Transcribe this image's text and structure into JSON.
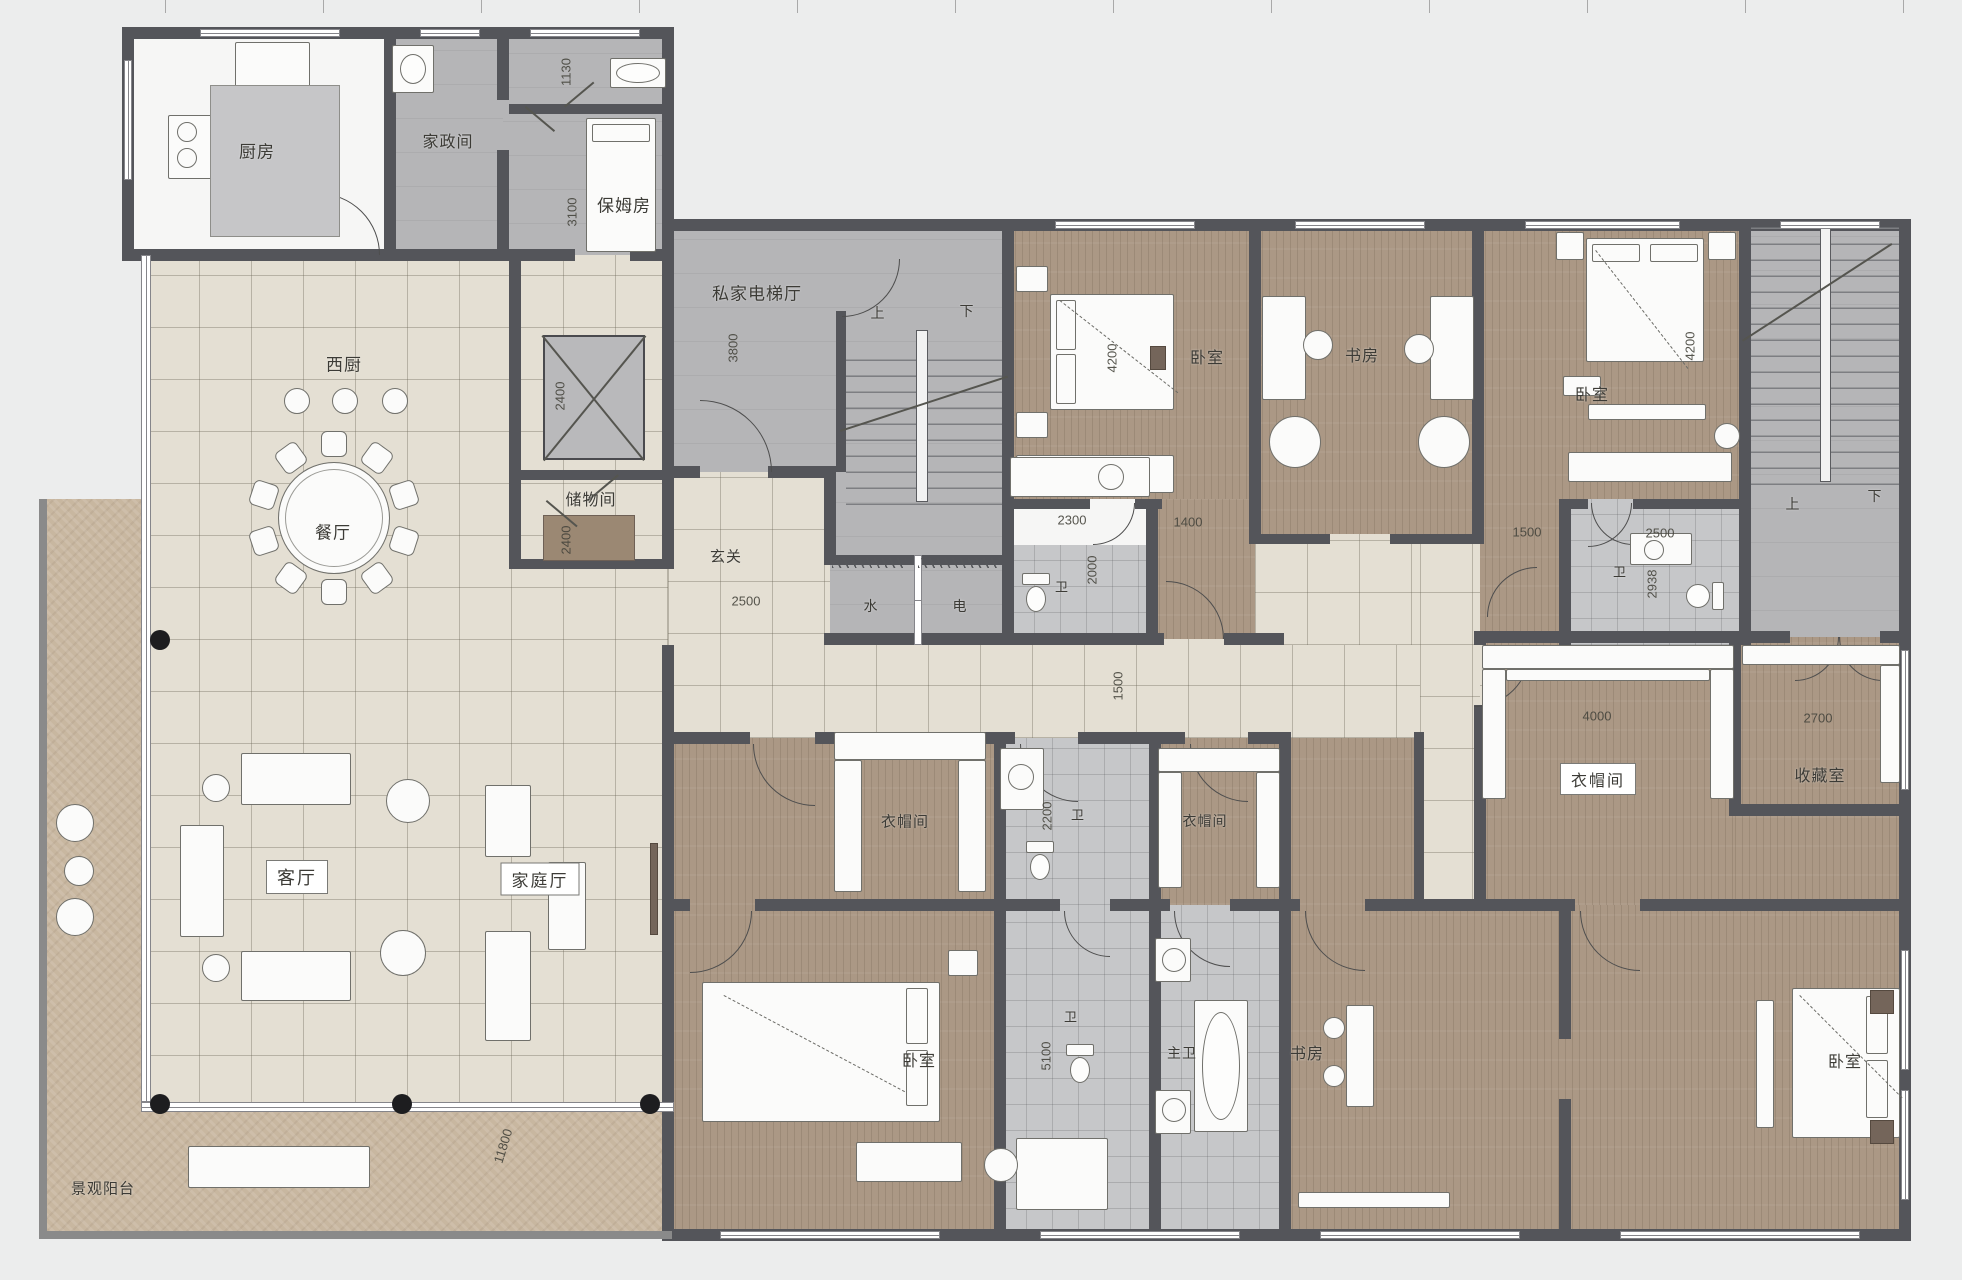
{
  "plan": {
    "title": "residential floor plan",
    "width": 1962,
    "height": 1280,
    "colors": {
      "wall": "#54555a",
      "tile_floor": "#e4dfd3",
      "wood_floor": "#ab9885",
      "gray_floor": "#b5b5b7",
      "bath_floor": "#c6c7c9",
      "balcony_floor": "#c8b7a0",
      "background": "#eceded",
      "label_text": "#3c3b36",
      "column": "#1d1d1f"
    }
  },
  "rooms": [
    {
      "name": "kitchen",
      "label": "厨房",
      "x": 257,
      "y": 150,
      "fs": 17,
      "boxed": false
    },
    {
      "name": "housekeeping-room",
      "label": "家政间",
      "x": 448,
      "y": 140,
      "fs": 16,
      "boxed": false
    },
    {
      "name": "nanny-room",
      "label": "保姆房",
      "x": 624,
      "y": 204,
      "fs": 17,
      "boxed": false
    },
    {
      "name": "private-elevator-hall",
      "label": "私家电梯厅",
      "x": 757,
      "y": 292,
      "fs": 17,
      "boxed": false
    },
    {
      "name": "west-kitchen",
      "label": "西厨",
      "x": 344,
      "y": 363,
      "fs": 17,
      "boxed": false
    },
    {
      "name": "dining-room",
      "label": "餐厅",
      "x": 333,
      "y": 531,
      "fs": 17,
      "boxed": false
    },
    {
      "name": "storage-room",
      "label": "储物间",
      "x": 591,
      "y": 498,
      "fs": 16,
      "boxed": false
    },
    {
      "name": "foyer",
      "label": "玄关",
      "x": 726,
      "y": 556,
      "fs": 15,
      "boxed": false
    },
    {
      "name": "water-meter",
      "label": "水",
      "x": 871,
      "y": 606,
      "fs": 14,
      "boxed": false
    },
    {
      "name": "electric-meter",
      "label": "电",
      "x": 960,
      "y": 606,
      "fs": 14,
      "boxed": false
    },
    {
      "name": "bedroom-1",
      "label": "卧室",
      "x": 1207,
      "y": 356,
      "fs": 16,
      "boxed": false
    },
    {
      "name": "study-1",
      "label": "书房",
      "x": 1362,
      "y": 354,
      "fs": 16,
      "boxed": false
    },
    {
      "name": "bedroom-2",
      "label": "卧室",
      "x": 1592,
      "y": 393,
      "fs": 16,
      "boxed": false
    },
    {
      "name": "bath-1",
      "label": "卫",
      "x": 1062,
      "y": 586,
      "fs": 13,
      "boxed": false
    },
    {
      "name": "bath-2",
      "label": "卫",
      "x": 1620,
      "y": 571,
      "fs": 13,
      "boxed": false
    },
    {
      "name": "stair1-up",
      "label": "上",
      "x": 878,
      "y": 313,
      "fs": 14,
      "boxed": false
    },
    {
      "name": "stair1-down",
      "label": "下",
      "x": 967,
      "y": 311,
      "fs": 14,
      "boxed": false
    },
    {
      "name": "stair2-up",
      "label": "上",
      "x": 1793,
      "y": 504,
      "fs": 14,
      "boxed": false
    },
    {
      "name": "stair2-down",
      "label": "下",
      "x": 1875,
      "y": 496,
      "fs": 14,
      "boxed": false
    },
    {
      "name": "living-room",
      "label": "客厅",
      "x": 297,
      "y": 877,
      "fs": 18,
      "boxed": true
    },
    {
      "name": "family-room",
      "label": "家庭厅",
      "x": 540,
      "y": 879,
      "fs": 17,
      "boxed": true
    },
    {
      "name": "closet-suite-left",
      "label": "衣帽间",
      "x": 905,
      "y": 821,
      "fs": 15,
      "boxed": false
    },
    {
      "name": "bath-guest",
      "label": "卫",
      "x": 1078,
      "y": 814,
      "fs": 13,
      "boxed": false
    },
    {
      "name": "closet-2",
      "label": "衣帽间",
      "x": 1205,
      "y": 821,
      "fs": 14,
      "boxed": false
    },
    {
      "name": "closet-3",
      "label": "衣帽间",
      "x": 1598,
      "y": 779,
      "fs": 16,
      "boxed": true
    },
    {
      "name": "collection-room",
      "label": "收藏室",
      "x": 1820,
      "y": 774,
      "fs": 16,
      "boxed": false
    },
    {
      "name": "bedroom-3",
      "label": "卧室",
      "x": 919,
      "y": 1059,
      "fs": 16,
      "boxed": false
    },
    {
      "name": "bath-mid",
      "label": "卫",
      "x": 1071,
      "y": 1016,
      "fs": 13,
      "boxed": false
    },
    {
      "name": "master-bath",
      "label": "主卫",
      "x": 1182,
      "y": 1053,
      "fs": 14,
      "boxed": false
    },
    {
      "name": "study-2",
      "label": "书房",
      "x": 1307,
      "y": 1052,
      "fs": 16,
      "boxed": false
    },
    {
      "name": "bedroom-4",
      "label": "卧室",
      "x": 1845,
      "y": 1060,
      "fs": 16,
      "boxed": false
    },
    {
      "name": "view-balcony",
      "label": "景观阳台",
      "x": 103,
      "y": 1188,
      "fs": 15,
      "boxed": false
    }
  ],
  "dims": [
    {
      "name": "dim-nanny-width",
      "text": "1130",
      "x": 566,
      "y": 72,
      "rot": -90
    },
    {
      "name": "dim-nanny-depth",
      "text": "3100",
      "x": 572,
      "y": 212,
      "rot": -90
    },
    {
      "name": "dim-elevator",
      "text": "2400",
      "x": 560,
      "y": 396,
      "rot": -90
    },
    {
      "name": "dim-elevator-hall",
      "text": "3800",
      "x": 733,
      "y": 348,
      "rot": -90
    },
    {
      "name": "dim-storage",
      "text": "2400",
      "x": 566,
      "y": 540,
      "rot": -90
    },
    {
      "name": "dim-foyer",
      "text": "2500",
      "x": 746,
      "y": 601,
      "rot": 0
    },
    {
      "name": "dim-bedroom1",
      "text": "4200",
      "x": 1112,
      "y": 358,
      "rot": -90
    },
    {
      "name": "dim-bath1-width",
      "text": "2300",
      "x": 1072,
      "y": 520,
      "rot": 0
    },
    {
      "name": "dim-bath1-depth",
      "text": "2000",
      "x": 1092,
      "y": 570,
      "rot": -90
    },
    {
      "name": "dim-closet1400",
      "text": "1400",
      "x": 1188,
      "y": 522,
      "rot": 0
    },
    {
      "name": "dim-lobby2",
      "text": "1500",
      "x": 1527,
      "y": 532,
      "rot": 0
    },
    {
      "name": "dim-bath2-width",
      "text": "2500",
      "x": 1660,
      "y": 533,
      "rot": 0
    },
    {
      "name": "dim-bath2-depth",
      "text": "2938",
      "x": 1652,
      "y": 584,
      "rot": -90
    },
    {
      "name": "dim-bedroom2",
      "text": "4200",
      "x": 1690,
      "y": 346,
      "rot": -90
    },
    {
      "name": "dim-closet3",
      "text": "4000",
      "x": 1597,
      "y": 716,
      "rot": 0
    },
    {
      "name": "dim-collection",
      "text": "2700",
      "x": 1818,
      "y": 718,
      "rot": 0
    },
    {
      "name": "dim-corridor",
      "text": "1500",
      "x": 1118,
      "y": 686,
      "rot": -90
    },
    {
      "name": "dim-guest-bath",
      "text": "2200",
      "x": 1047,
      "y": 816,
      "rot": -90
    },
    {
      "name": "dim-mid-bath",
      "text": "5100",
      "x": 1046,
      "y": 1056,
      "rot": -90
    },
    {
      "name": "dim-terrace",
      "text": "11800",
      "x": 503,
      "y": 1146,
      "rot": -73
    }
  ],
  "dining": {
    "chair_count": 10,
    "table_cx": 334,
    "table_cy": 518,
    "chair_radius": 74
  }
}
